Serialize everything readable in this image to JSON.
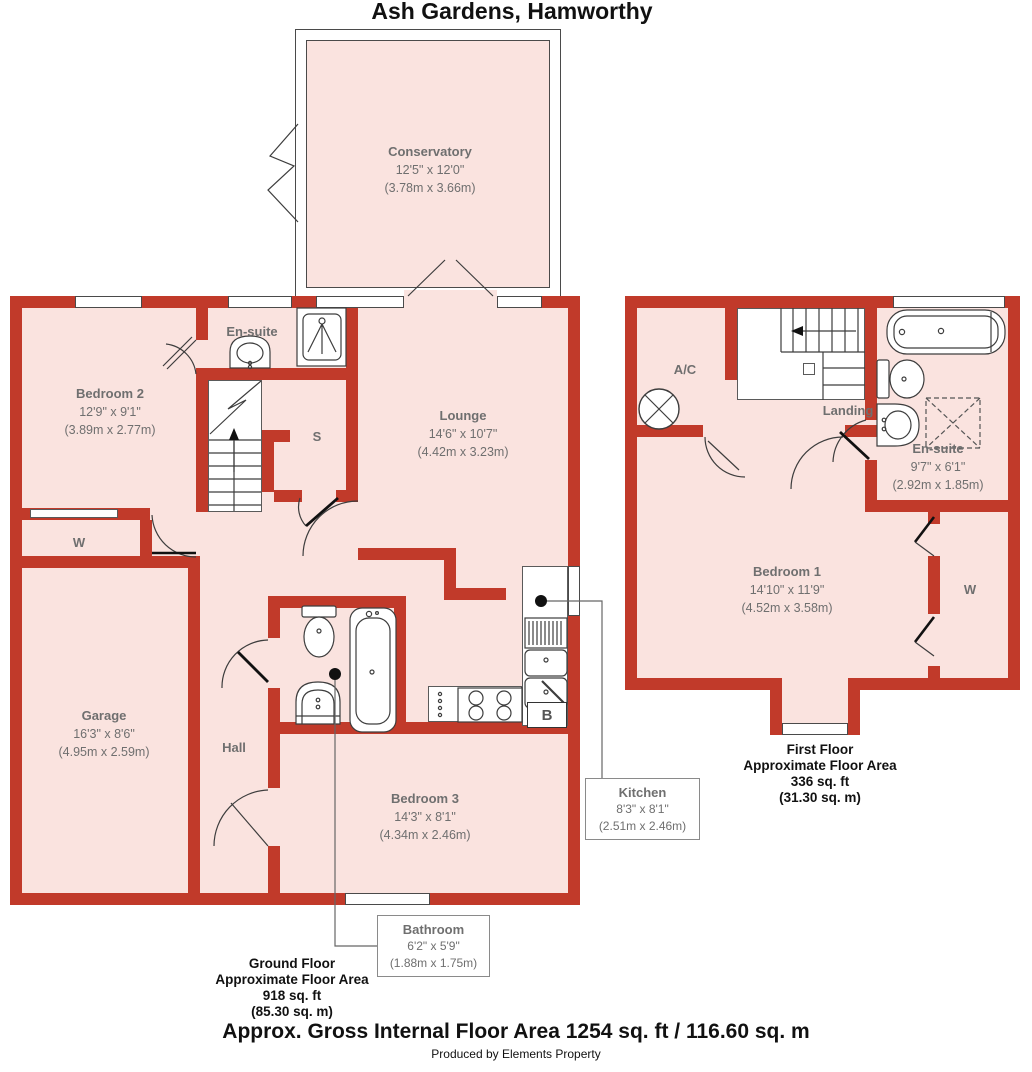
{
  "title": "Ash Gardens, Hamworthy",
  "ground_floor": {
    "rooms": {
      "conservatory": {
        "name": "Conservatory",
        "dims_ft": "12'5\" x 12'0\"",
        "dims_m": "(3.78m x 3.66m)"
      },
      "bedroom2": {
        "name": "Bedroom 2",
        "dims_ft": "12'9\" x 9'1\"",
        "dims_m": "(3.89m x 2.77m)"
      },
      "ensuite": {
        "name": "En-suite"
      },
      "lounge": {
        "name": "Lounge",
        "dims_ft": "14'6\" x 10'7\"",
        "dims_m": "(4.42m x 3.23m)"
      },
      "store": {
        "name": "S"
      },
      "wardrobe": {
        "name": "W"
      },
      "garage": {
        "name": "Garage",
        "dims_ft": "16'3\" x 8'6\"",
        "dims_m": "(4.95m x 2.59m)"
      },
      "hall": {
        "name": "Hall"
      },
      "bedroom3": {
        "name": "Bedroom 3",
        "dims_ft": "14'3\" x 8'1\"",
        "dims_m": "(4.34m x 2.46m)"
      },
      "kitchen": {
        "name": "Kitchen",
        "dims_ft": "8'3\" x 8'1\"",
        "dims_m": "(2.51m x 2.46m)"
      },
      "bathroom": {
        "name": "Bathroom",
        "dims_ft": "6'2\" x 5'9\"",
        "dims_m": "(1.88m x 1.75m)"
      },
      "boiler": {
        "name": "B"
      }
    },
    "summary": {
      "floor": "Ground Floor",
      "label": "Approximate Floor Area",
      "area_ft": "918 sq. ft",
      "area_m": "(85.30 sq. m)"
    }
  },
  "first_floor": {
    "rooms": {
      "airing_cupboard": {
        "name": "A/C"
      },
      "landing": {
        "name": "Landing"
      },
      "ensuite": {
        "name": "En-suite",
        "dims_ft": "9'7\" x 6'1\"",
        "dims_m": "(2.92m x 1.85m)"
      },
      "bedroom1": {
        "name": "Bedroom 1",
        "dims_ft": "14'10\" x 11'9\"",
        "dims_m": "(4.52m x 3.58m)"
      },
      "wardrobe": {
        "name": "W"
      }
    },
    "summary": {
      "floor": "First Floor",
      "label": "Approximate Floor Area",
      "area_ft": "336 sq. ft",
      "area_m": "(31.30 sq. m)"
    }
  },
  "footer": {
    "gross_area": "Approx. Gross Internal Floor Area 1254 sq. ft / 116.60 sq. m",
    "credit": "Produced by Elements Property"
  },
  "colors": {
    "wall": "#c13a2a",
    "room": "#fae3df",
    "label_text": "#6f6f6f"
  }
}
